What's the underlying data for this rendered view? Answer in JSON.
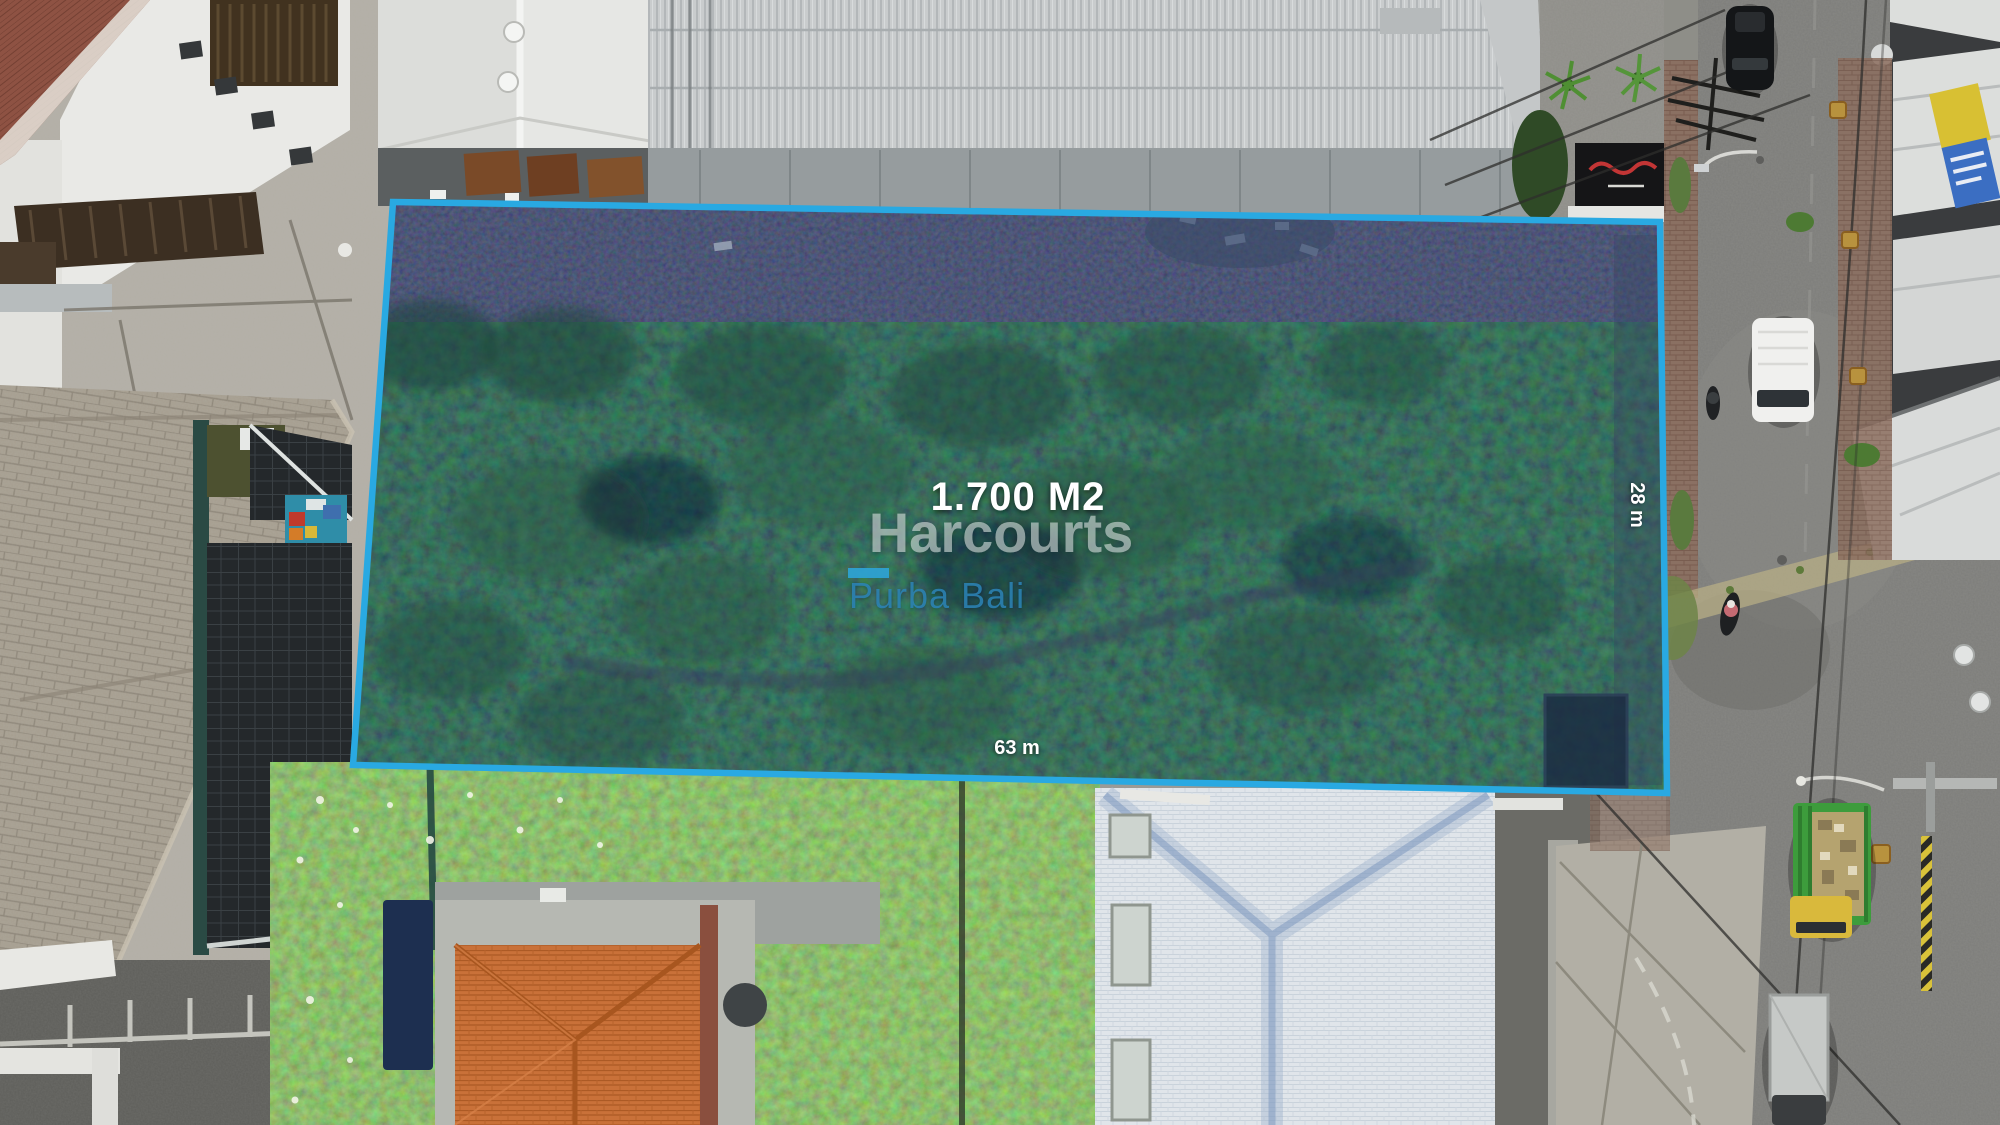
{
  "overlay": {
    "area_label": "1.700 M2",
    "brand": "Harcourts",
    "brand_sub": "Purba Bali",
    "width_label": "63 m",
    "depth_label": "28 m"
  },
  "colors": {
    "boundary_line": "#29a9e2",
    "brand_bar": "#2da4d8",
    "brand_text": "#dbe3e1",
    "brand_sub_text": "#2d85b9",
    "label_text": "#ffffff"
  }
}
